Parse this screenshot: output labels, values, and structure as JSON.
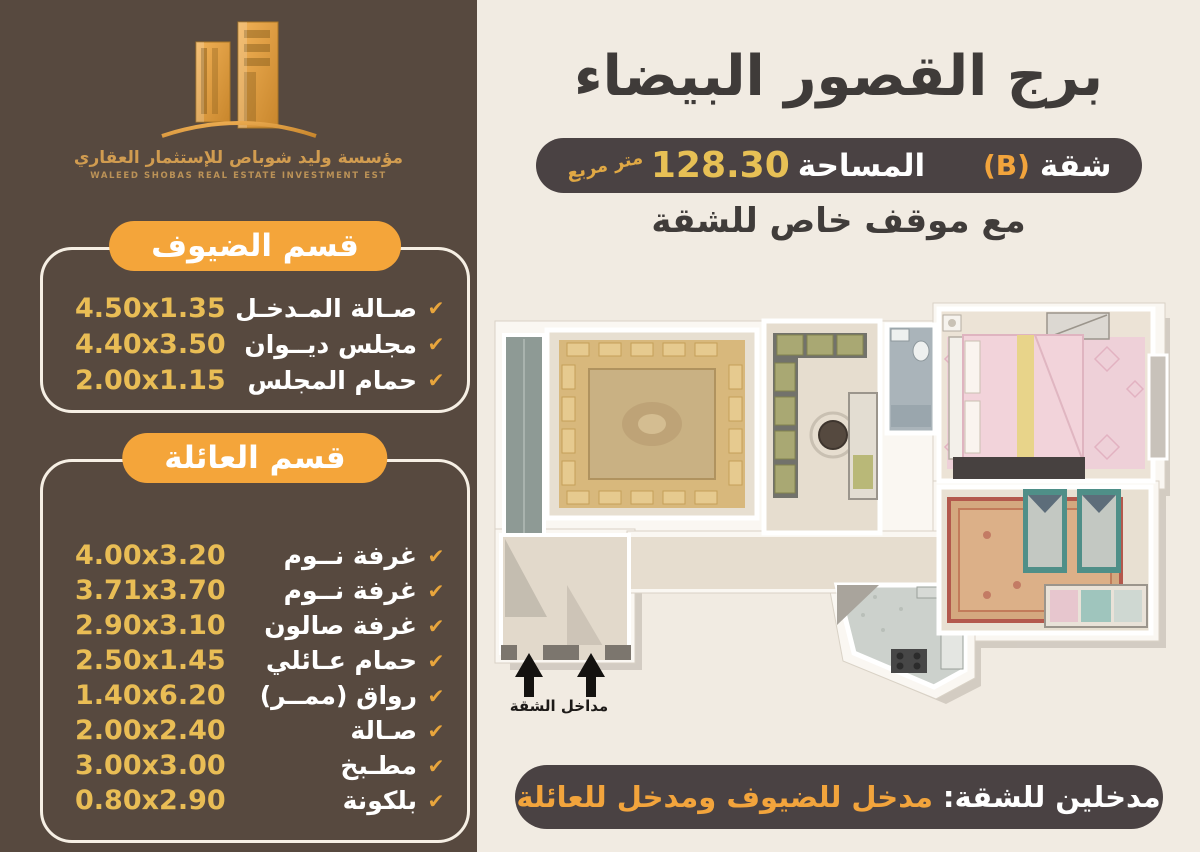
{
  "brand": {
    "name_ar": "مؤسسة وليد شوباص للإستثمار العقاري",
    "name_en": "WALEED SHOBAS REAL ESTATE INVESTMENT EST"
  },
  "header": {
    "title": "برج القصور البيضاء",
    "apartment_label": "شقة",
    "apartment_unit": "(B)",
    "area_label": "المساحة",
    "area_value": "128.30",
    "area_unit": "متر مربع",
    "parking_note": "مع موقف خاص للشقة"
  },
  "sections": [
    {
      "title": "قسم الضيوف",
      "items": [
        {
          "label": "صـالة المـدخـل",
          "dimensions": "4.50x1.35"
        },
        {
          "label": "مجلس ديــوان",
          "dimensions": "4.40x3.50"
        },
        {
          "label": "حمام المجلس",
          "dimensions": "2.00x1.15"
        }
      ]
    },
    {
      "title": "قسم العائلة",
      "items": [
        {
          "label": "غرفة نــوم",
          "dimensions": "4.00x3.20"
        },
        {
          "label": "غرفة نــوم",
          "dimensions": "3.71x3.70"
        },
        {
          "label": "غرفة صالون",
          "dimensions": "2.90x3.10"
        },
        {
          "label": "حمام عـائلي",
          "dimensions": "2.50x1.45"
        },
        {
          "label": "رواق (ممــر)",
          "dimensions": "1.40x6.20"
        },
        {
          "label": "صـالة",
          "dimensions": "2.00x2.40"
        },
        {
          "label": "مطـبخ",
          "dimensions": "3.00x3.00"
        },
        {
          "label": "بلكونة",
          "dimensions": "0.80x2.90"
        }
      ]
    }
  ],
  "floor_plan": {
    "entrances_label": "مداخل الشقة"
  },
  "footer": {
    "prefix": "مدخلين للشقة:",
    "highlight": "مدخل للضيوف ومدخل للعائلة"
  },
  "icons": {
    "check": "✔"
  },
  "colors": {
    "sidebar_bg": "#57493f",
    "panel_bg": "#f1ebe2",
    "accent_orange": "#f4a53a",
    "gold_text": "#e9bd55",
    "dark_pill_bg": "#4a4243",
    "heading_text": "#3f3b39"
  }
}
